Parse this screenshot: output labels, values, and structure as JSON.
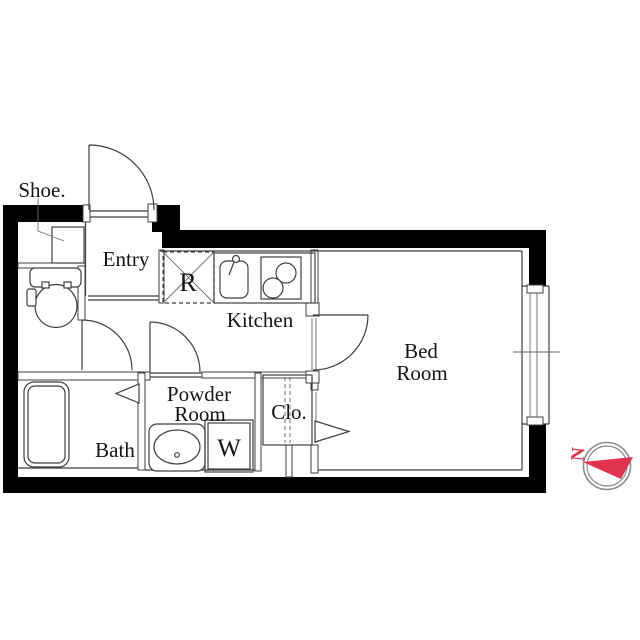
{
  "page": {
    "type": "apartment-floor-plan",
    "background": "#ffffff"
  },
  "rooms": {
    "shoe_cabinet": {
      "label": "Shoe."
    },
    "entry": {
      "label": "Entry"
    },
    "refrigerator_space": {
      "label": "R"
    },
    "kitchen": {
      "label": "Kitchen"
    },
    "bedroom": {
      "label_line1": "Bed",
      "label_line2": "Room"
    },
    "powder_room": {
      "label_line1": "Powder",
      "label_line2": "Room"
    },
    "closet": {
      "label": "Clo."
    },
    "bath": {
      "label": "Bath"
    },
    "washer_space": {
      "label": "W"
    }
  },
  "compass": {
    "north_label": "N"
  },
  "colors": {
    "wall": "#000000",
    "line": "#3f3f3f",
    "compass_red": "#e0344e",
    "compass_ring": "#8a8a8a",
    "background": "#ffffff"
  },
  "fixtures": [
    "toilet",
    "bathtub",
    "wash-basin",
    "kitchen-sink",
    "gas-stove",
    "refrigerator-space",
    "washing-machine-space",
    "sliding-window",
    "entry-door",
    "wc-door",
    "powder-room-door",
    "bedroom-door",
    "bath-folding-door",
    "closet-folding-door",
    "compass-north"
  ]
}
